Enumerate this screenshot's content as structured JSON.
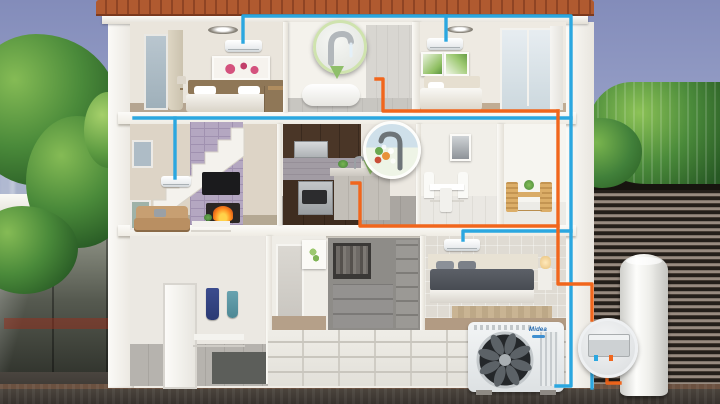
{
  "branding": {
    "outdoor_unit_logo": "Midea"
  },
  "legend_colors": {
    "hot_water_pipe": "#f1661c",
    "refrigerant_pipe": "#2ba7e0",
    "roof_tiles": "#b05a30",
    "foliage_green": "#3f7d35",
    "sky": "#98a1c8",
    "louver_fence": "#2f2822",
    "fireplace_fire": "#ff8c1f"
  },
  "equipment": {
    "outdoor_unit": "heat-pump-outdoor-unit",
    "water_tank": "hot-water-tank-cylinder",
    "hydraulic_module": "hydraulic-module-box",
    "indoor_ac_units": [
      "bedroom-upper-left",
      "bedroom-upper-right",
      "living-room",
      "bedroom-ground"
    ]
  },
  "insets": [
    {
      "name": "bathroom-faucet-closeup"
    },
    {
      "name": "kitchen-faucet-closeup"
    },
    {
      "name": "hydraulic-module-closeup"
    }
  ],
  "rooms": [
    "bedroom-upper-left",
    "bathroom",
    "bedroom-upper-right",
    "living-room",
    "kitchen",
    "dining-area",
    "balcony",
    "mudroom",
    "hallway",
    "wardrobe-closet",
    "bedroom-ground"
  ]
}
